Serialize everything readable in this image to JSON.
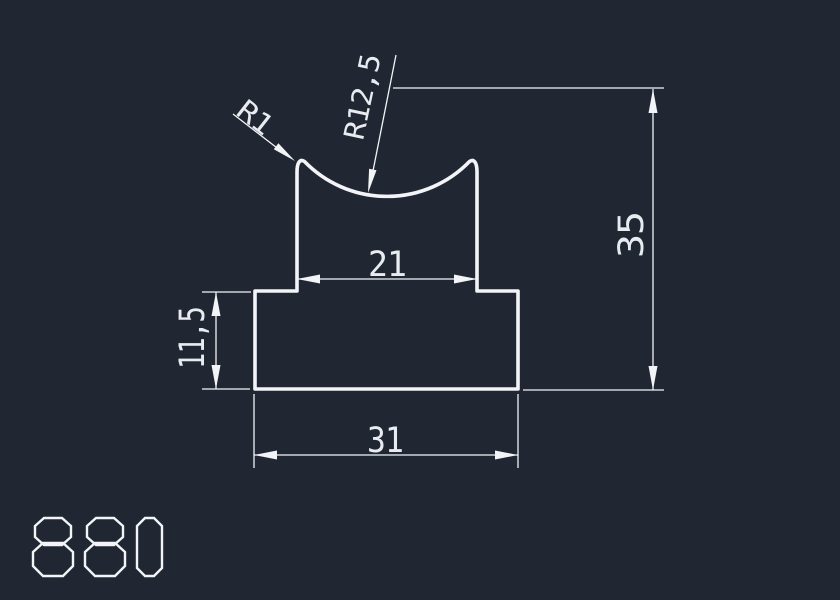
{
  "canvas": {
    "background_color": "#212732",
    "line_color": "#f2f4f7",
    "text_color": "#e8ebf0"
  },
  "drawing": {
    "part_number": "880",
    "dimension_labels": {
      "top_width": "21",
      "base_width": "31",
      "base_height": "11,5",
      "total_height": "35",
      "corner_radius": "R1",
      "groove_radius": "R12,5"
    }
  }
}
